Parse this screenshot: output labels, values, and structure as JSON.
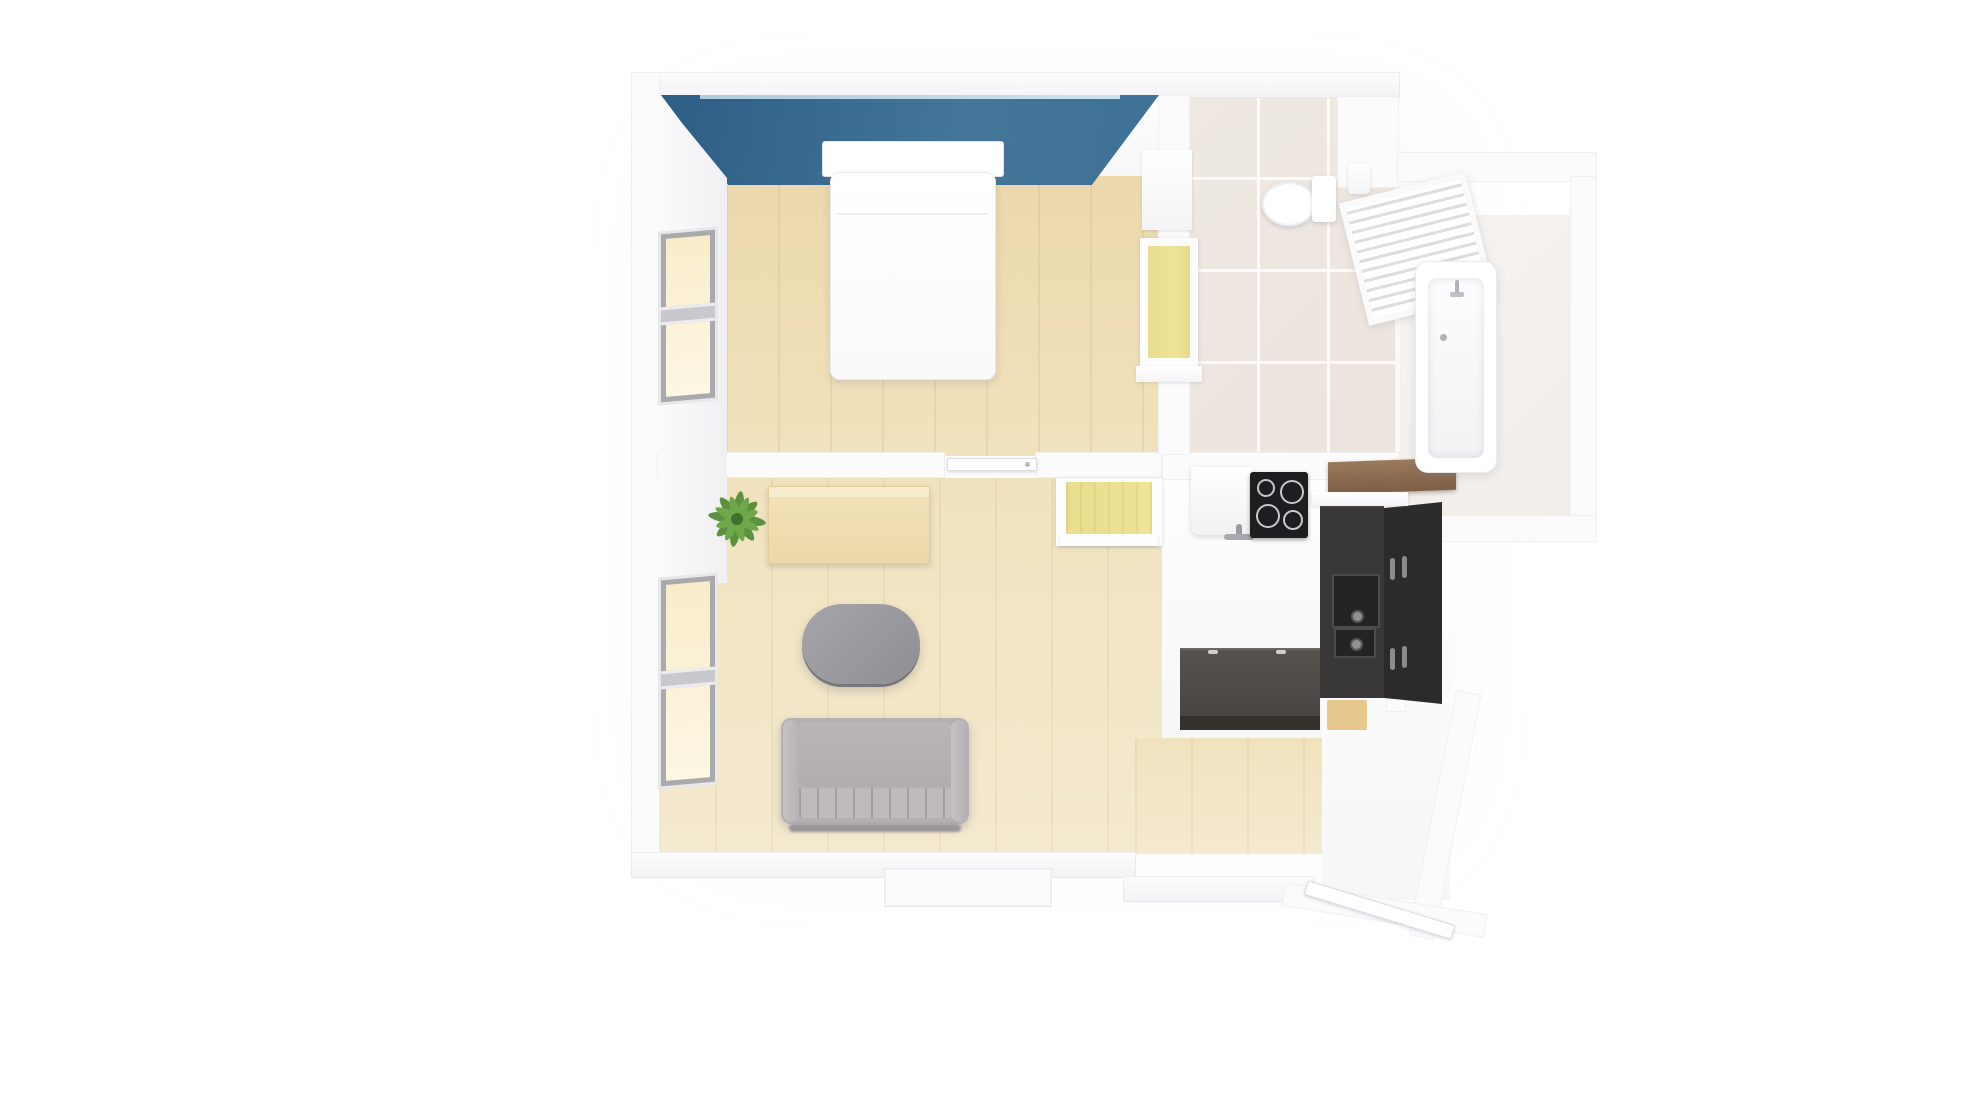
{
  "scene": {
    "title": "3D top-down floor plan of a studio apartment",
    "style": "photorealistic render, no text labels",
    "background": "#ffffff"
  },
  "palette": {
    "bg": "#ffffff",
    "accent-blue": "#447699",
    "accent-blue-dark": "#2c5e86",
    "wood": "#ecd8ab",
    "wood-light": "#f0e2bd",
    "niche-yellow": "#eee496",
    "glow": "#f8ecca",
    "tile": "#efe9e3",
    "frame-gray": "#aaaaad",
    "sofa-gray": "#b4afb3",
    "appliance-black": "#1e1d1f",
    "cabinet-dark": "#3a3738",
    "cabinet-darker": "#2c2a2b",
    "mat-tan": "#e6c88e",
    "shelf-brown": "#7e5e45"
  },
  "rooms": [
    {
      "name": "Bedroom",
      "floor": "light wood planks",
      "accent_wall_color": "#447699",
      "contents": [
        "double bed with white bedding",
        "blue accent wall",
        "window on left wall",
        "wardrobe with yellow-lit niche"
      ]
    },
    {
      "name": "Living room",
      "floor": "light wood planks",
      "contents": [
        "grey sofa",
        "grey oval coffee table",
        "light wood sideboard",
        "green potted plant",
        "window on left wall"
      ]
    },
    {
      "name": "Kitchen",
      "floor": "white and light wood",
      "contents": [
        "white sink counter with faucet",
        "black cooktop with 4 burners",
        "tall dark oven cabinet with two ovens",
        "dark grey kitchen island",
        "tan floor mat",
        "yellow storage niche"
      ]
    },
    {
      "name": "Bathroom",
      "floor": "beige ceramic tiles",
      "contents": [
        "toilet with cistern",
        "toilet paper holder",
        "white slatted towel radiator",
        "bathtub with faucet in alcove",
        "wooden shelf"
      ]
    },
    {
      "name": "Hallway / entry",
      "floor": "white",
      "contents": [
        "open entry door leaf"
      ]
    }
  ],
  "furniture_labels": {
    "bed": "Double bed",
    "sofa": "Sofa",
    "coffee_table": "Oval coffee table",
    "sideboard": "Sideboard",
    "plant": "Potted plant",
    "cooktop": "Cooktop",
    "sink_counter": "Sink counter",
    "oven_column": "Oven cabinet",
    "island": "Kitchen island",
    "toilet": "Toilet",
    "bathtub": "Bathtub",
    "radiator": "Towel radiator",
    "wood_shelf": "Wooden shelf",
    "entry_door": "Entry door"
  }
}
